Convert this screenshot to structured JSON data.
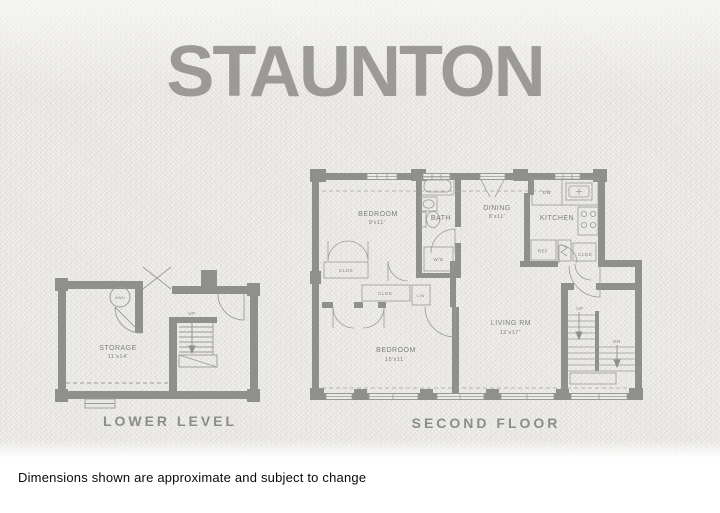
{
  "page": {
    "title": "STAUNTON",
    "disclaimer": "Dimensions shown are approximate and subject to change"
  },
  "colors": {
    "paper": "#e9e7e3",
    "wall_ink": "#8f8f8b",
    "line_ink": "#9a9a96",
    "label_ink": "#7d7d79",
    "title_ink": "#9b9a96",
    "disclaimer_ink": "#0a0a0a"
  },
  "lower_level": {
    "caption": "LOWER LEVEL",
    "storage": {
      "name": "STORAGE",
      "dims": "11'x14'"
    },
    "labels": {
      "hwh": "HWH",
      "up": "UP"
    }
  },
  "second_floor": {
    "caption": "SECOND FLOOR",
    "bedroom1": {
      "name": "BEDROOM",
      "dims": "9'x11'"
    },
    "bath": {
      "name": "BATH"
    },
    "dining": {
      "name": "DINING",
      "dims": "8'x11'"
    },
    "kitchen": {
      "name": "KITCHEN"
    },
    "bedroom2": {
      "name": "BEDROOM",
      "dims": "15'x11'"
    },
    "living": {
      "name": "LIVING RM",
      "dims": "12'x17'"
    },
    "labels": {
      "dw": "DW",
      "wd": "W/D",
      "ref": "REF",
      "clos_entry": "CLOS",
      "clos_hall1": "CLOS",
      "clos_hall2": "CLOS",
      "lin": "LIN",
      "up": "UP",
      "dn": "DN"
    }
  }
}
